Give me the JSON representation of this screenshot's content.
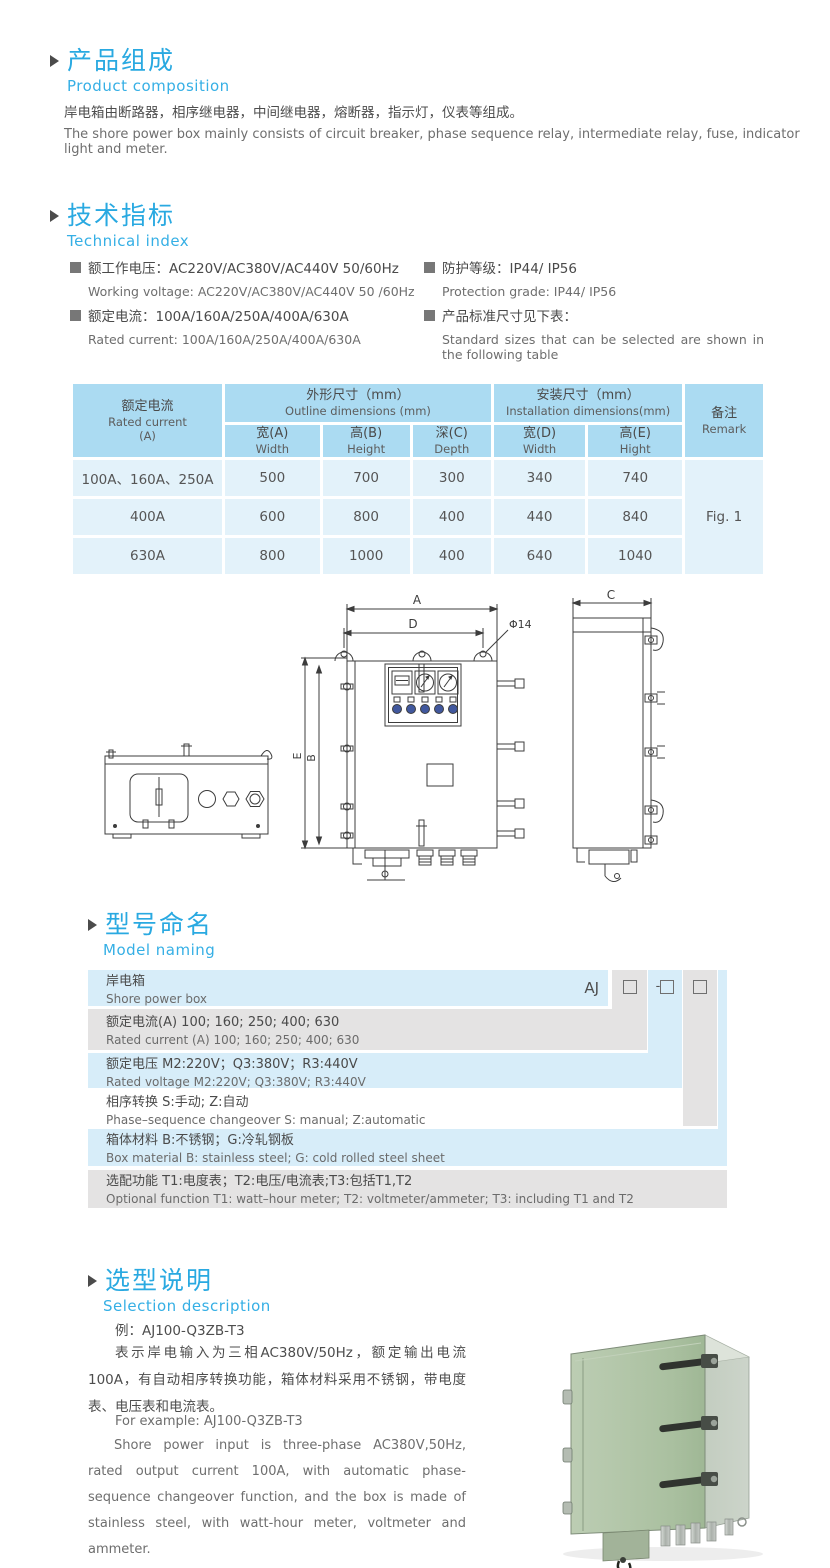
{
  "composition": {
    "title_cn": "产品组成",
    "title_en": "Product  composition",
    "body_cn": "岸电箱由断路器，相序继电器，中间继电器，熔断器，指示灯，仪表等组成。",
    "body_en": "The shore power box mainly consists of circuit breaker, phase sequence relay, intermediate relay, fuse, indicator light and meter."
  },
  "technical": {
    "title_cn": "技术指标",
    "title_en": "Technical index",
    "specs": [
      {
        "cn": "额工作电压：AC220V/AC380V/AC440V  50/60Hz",
        "en": "Working voltage: AC220V/AC380V/AC440V 50 /60Hz"
      },
      {
        "cn": "额定电流：100A/160A/250A/400A/630A",
        "en": "Rated current: 100A/160A/250A/400A/630A"
      },
      {
        "cn": "防护等级：IP44/ IP56",
        "en": "Protection grade: IP44/ IP56"
      },
      {
        "cn": "产品标准尺寸见下表：",
        "en": "Standard sizes that can be selected are shown in the following table"
      }
    ]
  },
  "table": {
    "header": {
      "current_cn": "额定电流",
      "current_en": "Rated current",
      "current_unit": "(A)",
      "outline_cn": "外形尺寸（mm）",
      "outline_en": "Outline dimensions (mm)",
      "install_cn": "安装尺寸（mm）",
      "install_en": "Installation dimensions(mm)",
      "remark_cn": "备注",
      "remark_en": "Remark",
      "sub": [
        {
          "cn": "宽(A)",
          "en": "Width"
        },
        {
          "cn": "高(B)",
          "en": "Height"
        },
        {
          "cn": "深(C)",
          "en": "Depth"
        },
        {
          "cn": "宽(D)",
          "en": "Width"
        },
        {
          "cn": "高(E)",
          "en": "Hight"
        }
      ]
    },
    "rows": [
      {
        "current": "100A、160A、250A",
        "w": "500",
        "h": "700",
        "d": "300",
        "iw": "340",
        "ih": "740"
      },
      {
        "current": "400A",
        "w": "600",
        "h": "800",
        "d": "400",
        "iw": "440",
        "ih": "840"
      },
      {
        "current": "630A",
        "w": "800",
        "h": "1000",
        "d": "400",
        "iw": "640",
        "ih": "1040"
      }
    ],
    "remark_value": "Fig. 1"
  },
  "drawing": {
    "dim_a": "A",
    "dim_d": "D",
    "dim_phi": "Φ14",
    "dim_e": "E",
    "dim_b": "B",
    "dim_c": "C"
  },
  "model_naming": {
    "title_cn": "型号命名",
    "title_en": "Model naming",
    "code_prefix": "AJ",
    "code_dash": "-",
    "rows": [
      {
        "cn": "岸电箱",
        "en": "Shore power box"
      },
      {
        "cn": "额定电流(A)  100; 160; 250; 400; 630",
        "en": "Rated current (A) 100; 160; 250; 400; 630"
      },
      {
        "cn": "额定电压   M2:220V；Q3:380V；R3:440V",
        "en": "Rated voltage  M2:220V;  Q3:380V;  R3:440V"
      },
      {
        "cn": "相序转换  S:手动; Z:自动",
        "en": "Phase–sequence changeover  S: manual;  Z:automatic"
      },
      {
        "cn": "箱体材料    B:不锈钢；G:冷轧钢板",
        "en": "Box material   B: stainless steel; G: cold rolled steel sheet"
      },
      {
        "cn": "选配功能      T1:电度表；T2:电压/电流表;T3:包括T1,T2",
        "en": "Optional function  T1: watt–hour meter; T2: voltmeter/ammeter; T3: including T1 and T2"
      }
    ]
  },
  "selection": {
    "title_cn": "选型说明",
    "title_en": "Selection description",
    "example_cn": "例：AJ100-Q3ZB-T3",
    "body_cn": "表示岸电输入为三相AC380V/50Hz，额定输出电流100A，有自动相序转换功能，箱体材料采用不锈钢，带电度表、电压表和电流表。",
    "example_en": "For example: AJ100-Q3ZB-T3",
    "body_en": "Shore power input is three-phase AC380V,50Hz, rated output current 100A, with automatic phase-sequence changeover function, and the box is made of stainless steel, with watt-hour meter, voltmeter and ammeter."
  },
  "colors": {
    "accent_blue": "#29a9e1",
    "table_header": "#abdbf2",
    "table_body": "#e3f2fa",
    "ladder_blue": "#d7edf9",
    "ladder_gray": "#e4e3e3",
    "box_green": "#b0c4a6"
  }
}
